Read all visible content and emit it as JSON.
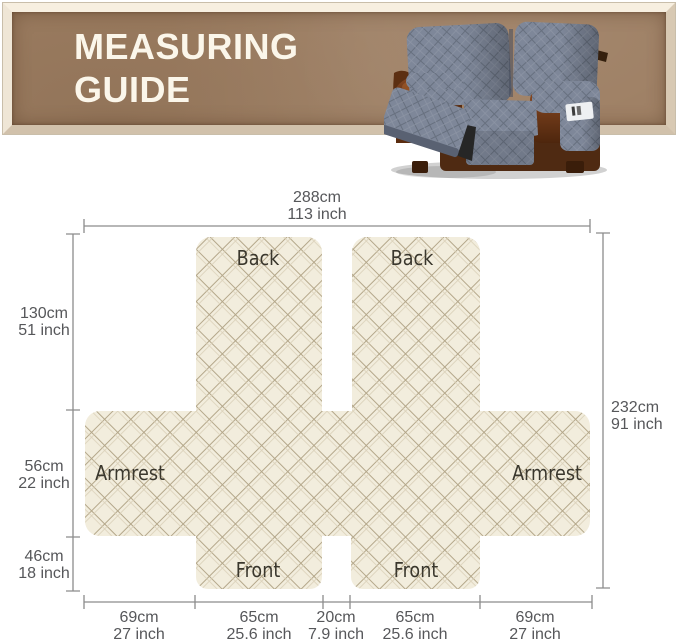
{
  "banner": {
    "title_line1": "MEASURING",
    "title_line2": "GUIDE"
  },
  "hero_image": {
    "name": "recliner-loveseat-with-gray-quilted-cover"
  },
  "diagram": {
    "labels": {
      "back_left": "Back",
      "back_right": "Back",
      "armrest_left": "Armrest",
      "armrest_right": "Armrest",
      "front_left": "Front",
      "front_right": "Front"
    },
    "measurements": {
      "top": {
        "cm": "288cm",
        "inch": "113 inch"
      },
      "right": {
        "cm": "232cm",
        "inch": "91 inch"
      },
      "left_back_height": {
        "cm": "130cm",
        "inch": "51 inch"
      },
      "left_armrest_height": {
        "cm": "56cm",
        "inch": "22 inch"
      },
      "left_front_height": {
        "cm": "46cm",
        "inch": "18 inch"
      },
      "bottom_armrest_left": {
        "cm": "69cm",
        "inch": "27 inch"
      },
      "bottom_front_left": {
        "cm": "65cm",
        "inch": "25.6 inch"
      },
      "bottom_center_gap": {
        "cm": "20cm",
        "inch": "7.9 inch"
      },
      "bottom_front_right": {
        "cm": "65cm",
        "inch": "25.6 inch"
      },
      "bottom_armrest_right": {
        "cm": "69cm",
        "inch": "27 inch"
      }
    },
    "colors": {
      "fabric": "#F2EDDD",
      "stitch": "#B4A78A",
      "dimension_line": "#8C8C8C",
      "panel_label_text": "#3A372D",
      "measurement_text": "#56575A",
      "banner_wood": "#9C7D61",
      "banner_frame": "#EFE4D3",
      "banner_text": "#FBF6EA",
      "cover_gray": "#7E8799",
      "leather_brown": "#6B3A1B"
    }
  }
}
